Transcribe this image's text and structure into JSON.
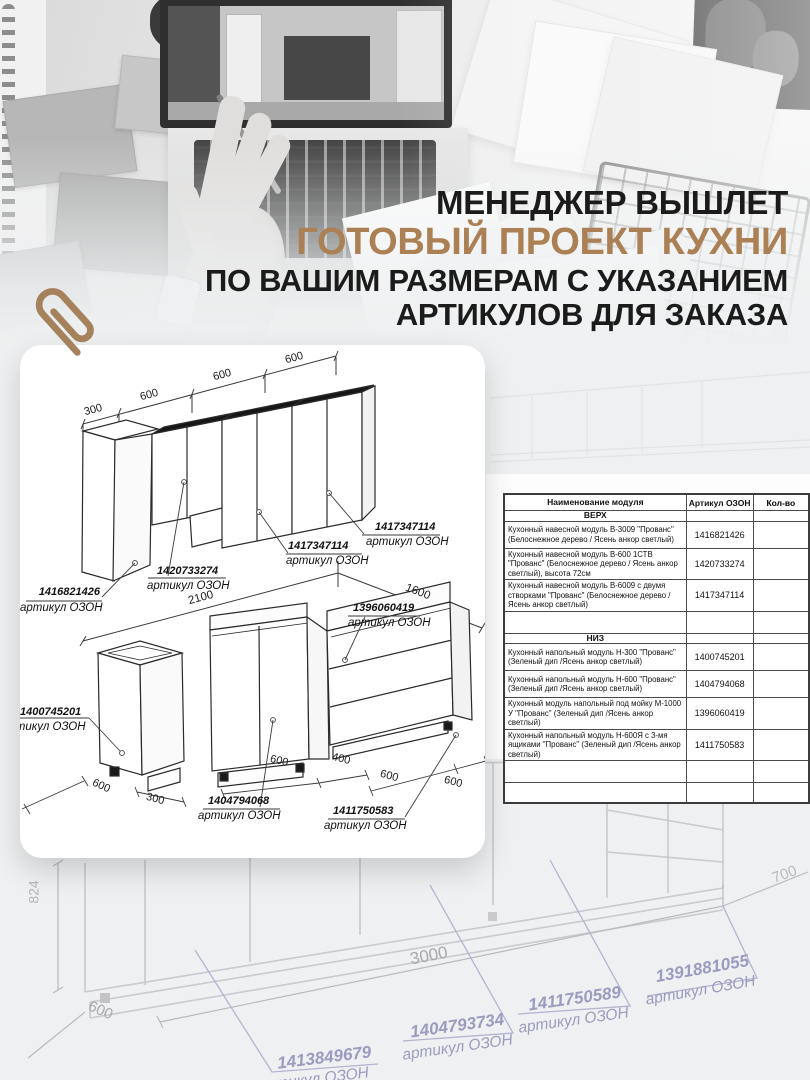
{
  "headline": {
    "line1": "МЕНЕДЖЕР ВЫШЛЕТ",
    "line2": "ГОТОВЫЙ ПРОЕКТ КУХНИ",
    "line3": "ПО ВАШИМ РАЗМЕРАМ С УКАЗАНИЕМ",
    "line4": "АРТИКУЛОВ ДЛЯ ЗАКАЗА",
    "accent_color": "#ac8055",
    "text_color": "#1b1b1b"
  },
  "card": {
    "upper": {
      "dims": [
        "300",
        "600",
        "600",
        "600"
      ],
      "labels": [
        {
          "num": "1416821426",
          "cap": "артикул ОЗОН"
        },
        {
          "num": "1420733274",
          "cap": "артикул ОЗОН"
        },
        {
          "num": "1417347114",
          "cap": "артикул ОЗОН"
        },
        {
          "num": "1417347114",
          "cap": "артикул ОЗОН"
        }
      ]
    },
    "lower": {
      "dims": {
        "w1": "2100",
        "w2": "1600",
        "depth": "600",
        "w300": "300",
        "b1": "600",
        "b2": "400",
        "b3": "600",
        "b4": "600"
      },
      "labels": [
        {
          "num": "1400745201",
          "cap": "артикул ОЗОН"
        },
        {
          "num": "1396060419",
          "cap": "артикул ОЗОН"
        },
        {
          "num": "1404794068",
          "cap": "артикул ОЗОН"
        },
        {
          "num": "1411750583",
          "cap": "артикул ОЗОН"
        }
      ]
    }
  },
  "table": {
    "headers": [
      "Наименование модуля",
      "Артикул ОЗОН",
      "Кол-во"
    ],
    "sections": [
      {
        "title": "ВЕРХ",
        "rows": [
          {
            "name": "Кухонный навесной модуль В-3009 \"Прованс\" (Белоснежное дерево / Ясень анкор светлый)",
            "article": "1416821426"
          },
          {
            "name": "Кухонный навесной модуль В-600 1СТВ \"Прованс\" (Белоснежное дерево / Ясень анкор светлый), высота 72см",
            "article": "1420733274"
          },
          {
            "name": "Кухонный навесной модуль В-6009 с двумя створками \"Прованс\" (Белоснежное дерево / Ясень анкор светлый)",
            "article": "1417347114"
          }
        ]
      },
      {
        "title": "НИЗ",
        "rows": [
          {
            "name": "Кухонный напольный модуль Н-300 \"Прованс\" (Зеленый дип /Ясень анкор светлый)",
            "article": "1400745201"
          },
          {
            "name": "Кухонный напольный модуль Н-600 \"Прованс\" (Зеленый дип /Ясень анкор светлый)",
            "article": "1404794068"
          },
          {
            "name": "Кухонный модуль напольный под мойку М-1000 У \"Прованс\" (Зеленый дип /Ясень анкор светлый)",
            "article": "1396060419"
          },
          {
            "name": "Кухонный напольный модуль Н-600Я с 3-мя ящиками \"Прованс\" (Зеленый дип /Ясень анкор светлый)",
            "article": "1411750583"
          }
        ]
      }
    ]
  },
  "sketch": {
    "dims": {
      "height": "824",
      "depth": "600",
      "width": "3000",
      "end": "700"
    },
    "labels": [
      {
        "num": "1413849679",
        "cap": "артикул ОЗОН"
      },
      {
        "num": "1404793734",
        "cap": "артикул ОЗОН"
      },
      {
        "num": "1411750589",
        "cap": "артикул ОЗОН"
      },
      {
        "num": "1391881055",
        "cap": "артикул ОЗОН"
      }
    ]
  }
}
